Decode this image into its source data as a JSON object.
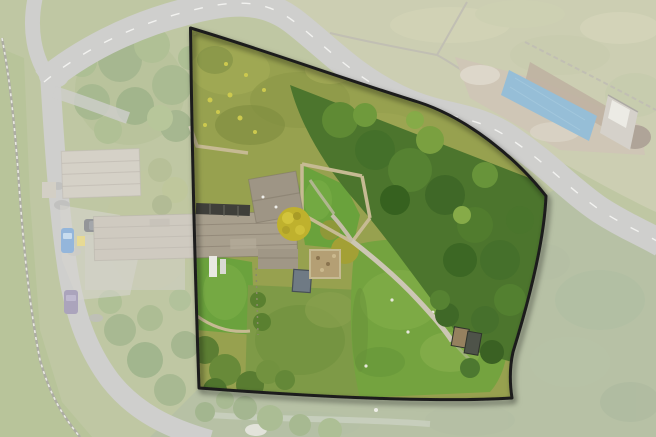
{
  "scene": {
    "kind": "aerial-drone-photograph",
    "subject": "farmhouse property with highlighted plot boundary",
    "width": 656,
    "height": 437
  },
  "boundary": {
    "path": "M190.5,28 C255,47 335,76 418,102 C468,118 516,158 546,196 C544,246 526,310 513,352 C509,370 510,385 512,398 C430,403 305,396 199,388 C195,270 192,150 190.5,28 Z",
    "stroke": "#1c1c1c",
    "stroke_width": 3,
    "fade_color": "#ffffff",
    "fade_opacity": 0.45
  },
  "colors": {
    "road": "#a8a8a4",
    "road_line": "#f2f2ee",
    "road_patch": "#8a8a86",
    "field_top": "#a2a673",
    "field_bottom": "#7c8f5c",
    "verge": "#7f9447",
    "base_left": "#8a9a58",
    "scrub": "#97a14f",
    "lawn_left": "#6ba23d",
    "lawn_mid": "#7e9a47",
    "lawn_right": "#74a33f",
    "garden_lawn": "#6aa23c",
    "woodland": "#4c752d",
    "canopy_light": "#5f8a34",
    "tree_yellow": "#bfb12d",
    "roof_main": "#a89f8d",
    "roof_barn": "#b3ab99",
    "roof_north": "#9e9585",
    "roof_ridge": "#8b8272",
    "solar_dark": "#3f3f3a",
    "stone_wall": "#c6ba93",
    "wall_gray": "#8f8a76",
    "footpath": "#ccc6b4",
    "dirt": "#a8977a",
    "dirt_dark": "#8b7355",
    "tarp_blue": "#4089b6",
    "structure_gray": "#b2ac9e",
    "car_blue": "#3d7bbd",
    "car_dark": "#3c4046",
    "car_purple": "#665a85",
    "bin_yellow": "#d4bc3c",
    "shed": "#6f7a84",
    "hut_roof": "#96815f",
    "hut_dark": "#4e5349"
  }
}
